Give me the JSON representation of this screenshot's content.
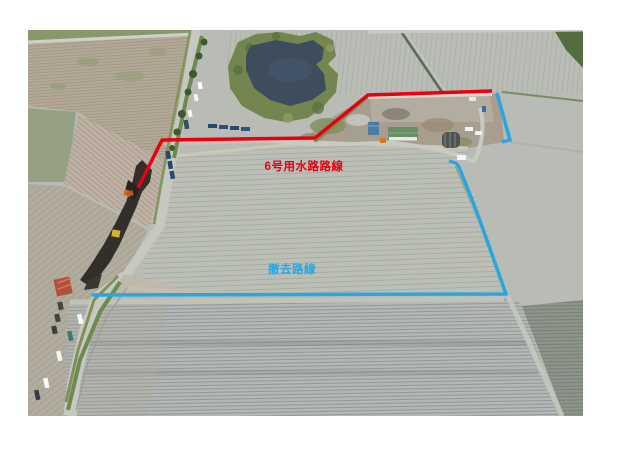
{
  "page": {
    "background_color": "#ffffff"
  },
  "photo": {
    "description": "aerial-drone-photo-of-farm-fields-construction-site",
    "water_color": "#3d4d5c",
    "vegetation_color": "#74854f",
    "field_color": "#b9bcb4"
  },
  "annotations": {
    "red_route": {
      "label": "6号用水路路線",
      "color": "#e60012"
    },
    "blue_route": {
      "label": "撤去路線",
      "color": "#29a6df"
    }
  }
}
